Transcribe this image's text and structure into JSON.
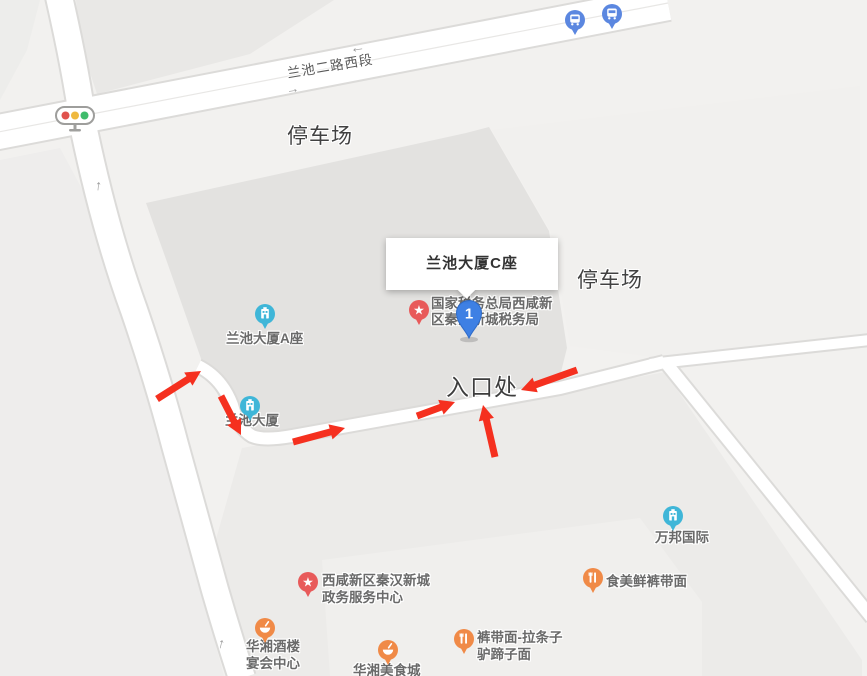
{
  "road_label": "兰池二路西段",
  "area_labels": {
    "parking_top": "停车场",
    "parking_east": "停车场",
    "entrance": "入口处"
  },
  "popup": {
    "title": "兰池大厦C座"
  },
  "route_marker": {
    "number": "1"
  },
  "pois": {
    "tax_bureau": {
      "line1": "国家税务总局西咸新",
      "line2": "区秦汉新城税务局"
    },
    "lanchi_tower_a": {
      "label": "兰池大厦A座"
    },
    "lanchi_tower": {
      "label": "兰池大厦"
    },
    "wanbang_intl": {
      "label": "万邦国际"
    },
    "gov_service_center": {
      "line1": "西咸新区秦汉新城",
      "line2": "政务服务中心"
    },
    "shimeixian_noodle": {
      "label": "食美鲜裤带面"
    },
    "kudaimian_noodle": {
      "line1": "裤带面-拉条子",
      "line2": "驴蹄子面"
    },
    "huaxiang_banquet": {
      "line1": "华湘酒楼",
      "line2": "宴会中心"
    },
    "huaxiang_food_city": {
      "label": "华湘美食城"
    }
  },
  "lane_arrows": {
    "west": "←",
    "east": "→",
    "north_upper": "↑",
    "north_lower": "↑"
  },
  "route_arrows": {
    "color": "#f5301f",
    "segments": [
      {
        "x1": 157,
        "y1": 399,
        "x2": 201,
        "y2": 371
      },
      {
        "x1": 221,
        "y1": 396,
        "x2": 241,
        "y2": 435
      },
      {
        "x1": 293,
        "y1": 442,
        "x2": 345,
        "y2": 428
      },
      {
        "x1": 417,
        "y1": 416,
        "x2": 455,
        "y2": 402
      },
      {
        "x1": 495,
        "y1": 457,
        "x2": 483,
        "y2": 405
      },
      {
        "x1": 577,
        "y1": 370,
        "x2": 521,
        "y2": 390
      }
    ]
  },
  "colors": {
    "poi_cyan": "#3fb6d8",
    "poi_orange": "#f08a47",
    "poi_red_pin": "#e85a5a",
    "bus_blue": "#5b87e0",
    "marker_blue": "#3e80e4",
    "traffic_red": "#e0524d",
    "traffic_yellow": "#efb93f",
    "traffic_green": "#3fbc6b",
    "road_fill": "#ffffff",
    "block_dark": "#e3e2e0"
  }
}
